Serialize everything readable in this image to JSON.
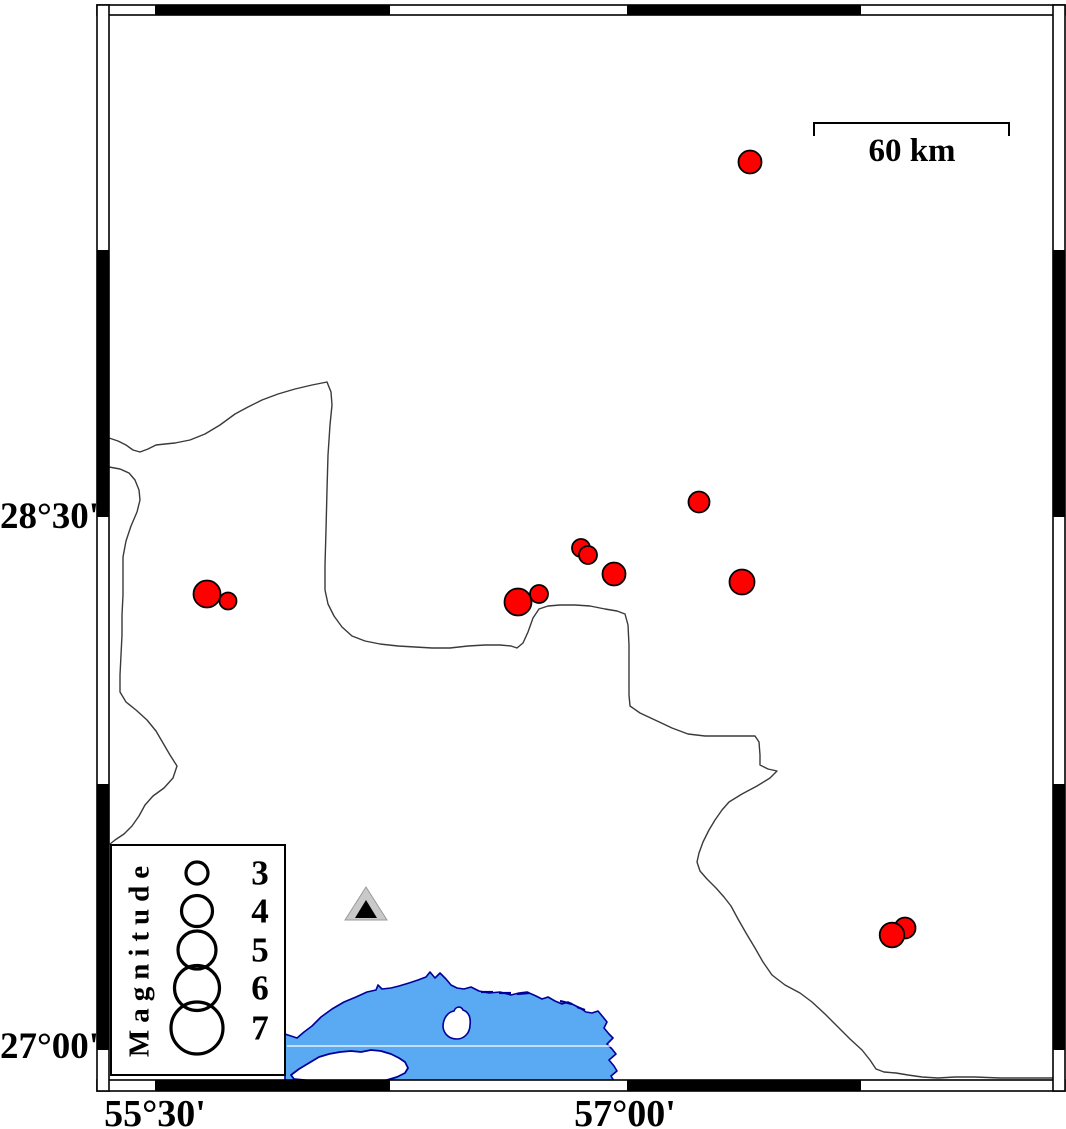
{
  "map": {
    "axis_labels": {
      "left": [
        {
          "text": "28°30'",
          "y": 517
        },
        {
          "text": "27°00'",
          "y": 1047
        }
      ],
      "bottom": [
        {
          "text": "55°30'",
          "x": 155
        },
        {
          "text": "57°00'",
          "x": 625
        }
      ]
    },
    "scale_bar": {
      "label": "60 km"
    }
  },
  "legend": {
    "title": "Magnitude",
    "circle_cx": 197,
    "number_x": 260,
    "entries": [
      {
        "label": "3",
        "cy": 873,
        "r": 11
      },
      {
        "label": "4",
        "cy": 911,
        "r": 15.5
      },
      {
        "label": "5",
        "cy": 950,
        "r": 19
      },
      {
        "label": "6",
        "cy": 988,
        "r": 22.5
      },
      {
        "label": "7",
        "cy": 1028,
        "r": 26
      }
    ]
  },
  "earthquakes": {
    "marker_shape": "circle",
    "events": [
      {
        "x": 750,
        "y": 162,
        "r": 11.5
      },
      {
        "x": 699,
        "y": 502,
        "r": 10.5
      },
      {
        "x": 581,
        "y": 548,
        "r": 9
      },
      {
        "x": 588,
        "y": 555,
        "r": 9
      },
      {
        "x": 614,
        "y": 574,
        "r": 11.5
      },
      {
        "x": 518,
        "y": 602,
        "r": 13.5
      },
      {
        "x": 539,
        "y": 594,
        "r": 9
      },
      {
        "x": 742,
        "y": 582,
        "r": 12.5
      },
      {
        "x": 207,
        "y": 594,
        "r": 13.5
      },
      {
        "x": 228,
        "y": 601,
        "r": 8.5
      },
      {
        "x": 905,
        "y": 928,
        "r": 10.5
      },
      {
        "x": 892,
        "y": 935,
        "r": 12.3
      }
    ]
  },
  "station": {
    "x": 366,
    "y": 905
  },
  "colors": {
    "marker_fill": "#ff0000",
    "marker_stroke": "#000000",
    "water_fill": "#59a9f3",
    "water_stroke": "#000099",
    "boundary_line": "#3a3a3a",
    "frame": "#000000",
    "station_fill": "#c9c9c9",
    "station_inner": "#000000"
  }
}
